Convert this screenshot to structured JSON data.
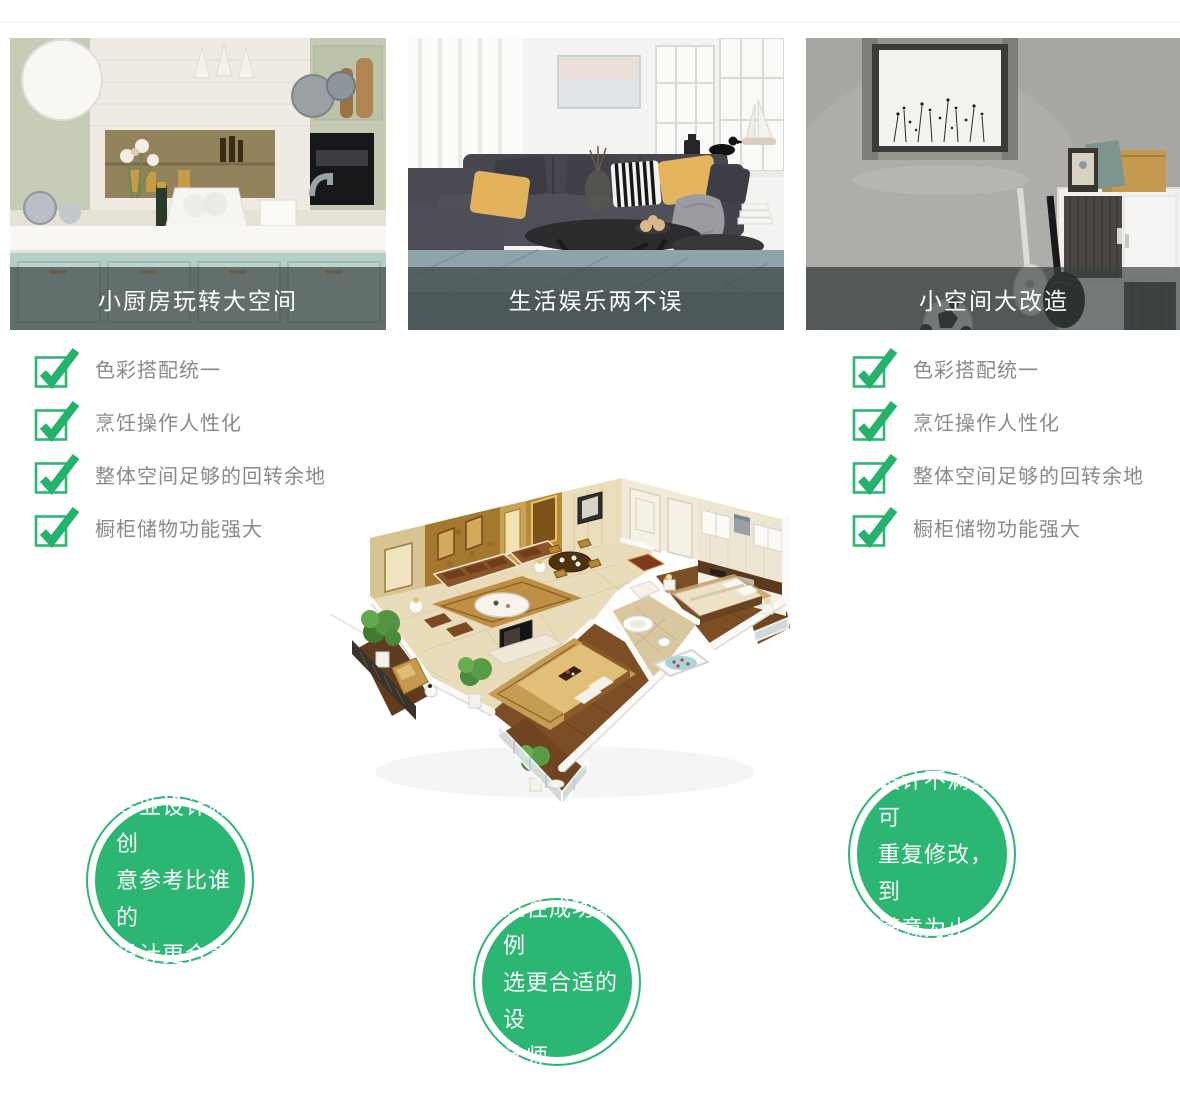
{
  "colors": {
    "accent_green": "#2bb673",
    "check_green": "#24b26d",
    "checklist_text": "#8a8a8a",
    "caption_bar": "rgba(56,64,62,0.68)",
    "caption_text": "#ffffff"
  },
  "cards": [
    {
      "caption": "小厨房玩转大空间",
      "image": "kitchen-showcase-photo"
    },
    {
      "caption": "生活娱乐两不误",
      "image": "living-room-showcase-photo"
    },
    {
      "caption": "小空间大改造",
      "image": "small-space-showcase-photo"
    }
  ],
  "checklists": {
    "left": {
      "items": [
        "色彩搭配统一",
        "烹饪操作人性化",
        "整体空间足够的回转余地",
        "橱柜储物功能强大"
      ]
    },
    "right": {
      "items": [
        "色彩搭配统一",
        "烹饪操作人性化",
        "整体空间足够的回转余地",
        "橱柜储物功能强大"
      ]
    }
  },
  "floorplan": {
    "image": "isometric-3d-apartment-rendering"
  },
  "bubbles": {
    "left": {
      "lines": [
        "专业设计师创",
        "意参考比谁的",
        "设计更合意"
      ]
    },
    "center": {
      "lines": [
        "过往成功案例",
        "选更合适的设",
        "计师"
      ]
    },
    "right": {
      "lines": [
        "设计不满意可",
        "重复修改，到",
        "满意为止"
      ]
    }
  }
}
